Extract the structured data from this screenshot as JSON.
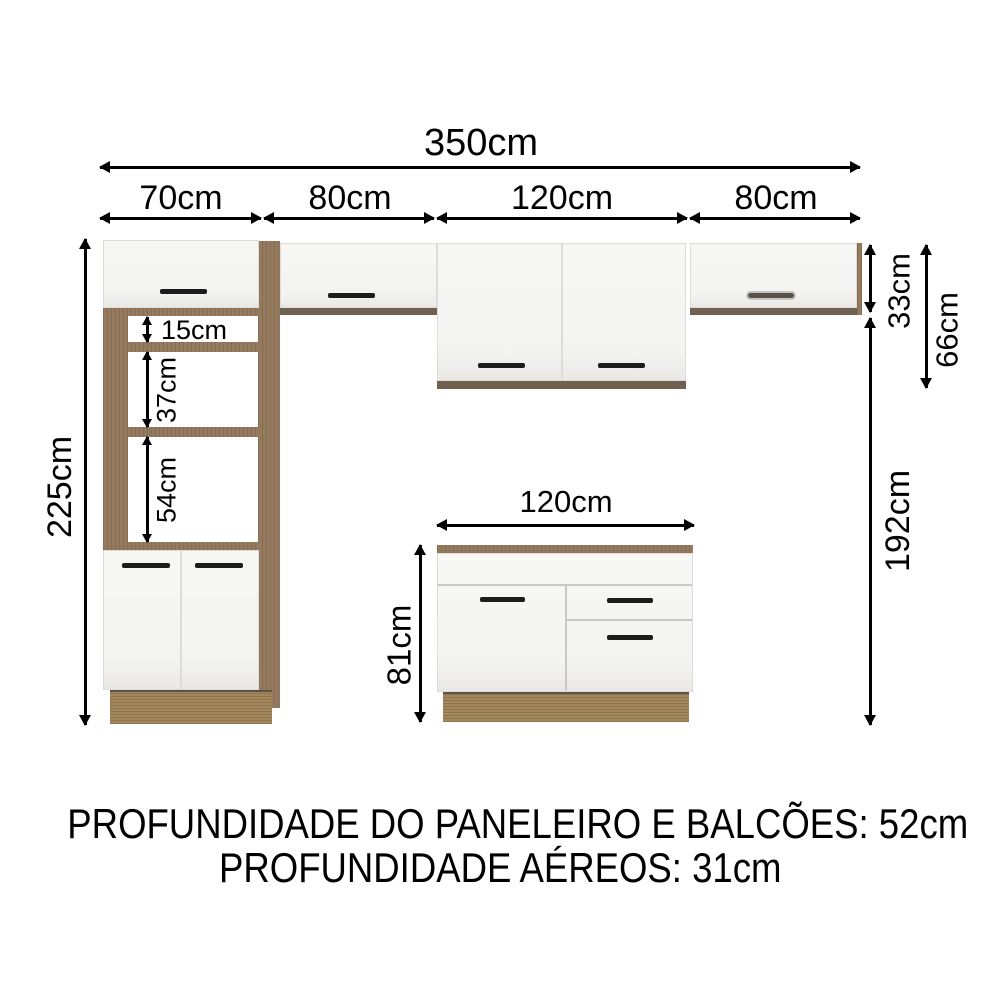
{
  "dims": {
    "total": "350cm",
    "segments": [
      "70cm",
      "80cm",
      "120cm",
      "80cm"
    ],
    "left_height": "225cm",
    "shelves": [
      "15cm",
      "37cm",
      "54cm"
    ],
    "aereo_height": "33cm",
    "aereo_tall_height": "66cm",
    "below_aereo": "192cm",
    "base_width": "120cm",
    "base_height": "81cm"
  },
  "notes": {
    "line1": "PROFUNDIDADE DO PANELEIRO E BALCÕES: 52cm",
    "line2": "PROFUNDIDADE AÉREOS: 31cm"
  },
  "colors": {
    "wood": "#8e7355",
    "wood_plinth": "#9c7f54",
    "wood_shadow_strip": "#6f6050",
    "door_white": "#f5f5f3",
    "handle_dark": "#1c1c1c",
    "dimension_line": "#000000"
  }
}
